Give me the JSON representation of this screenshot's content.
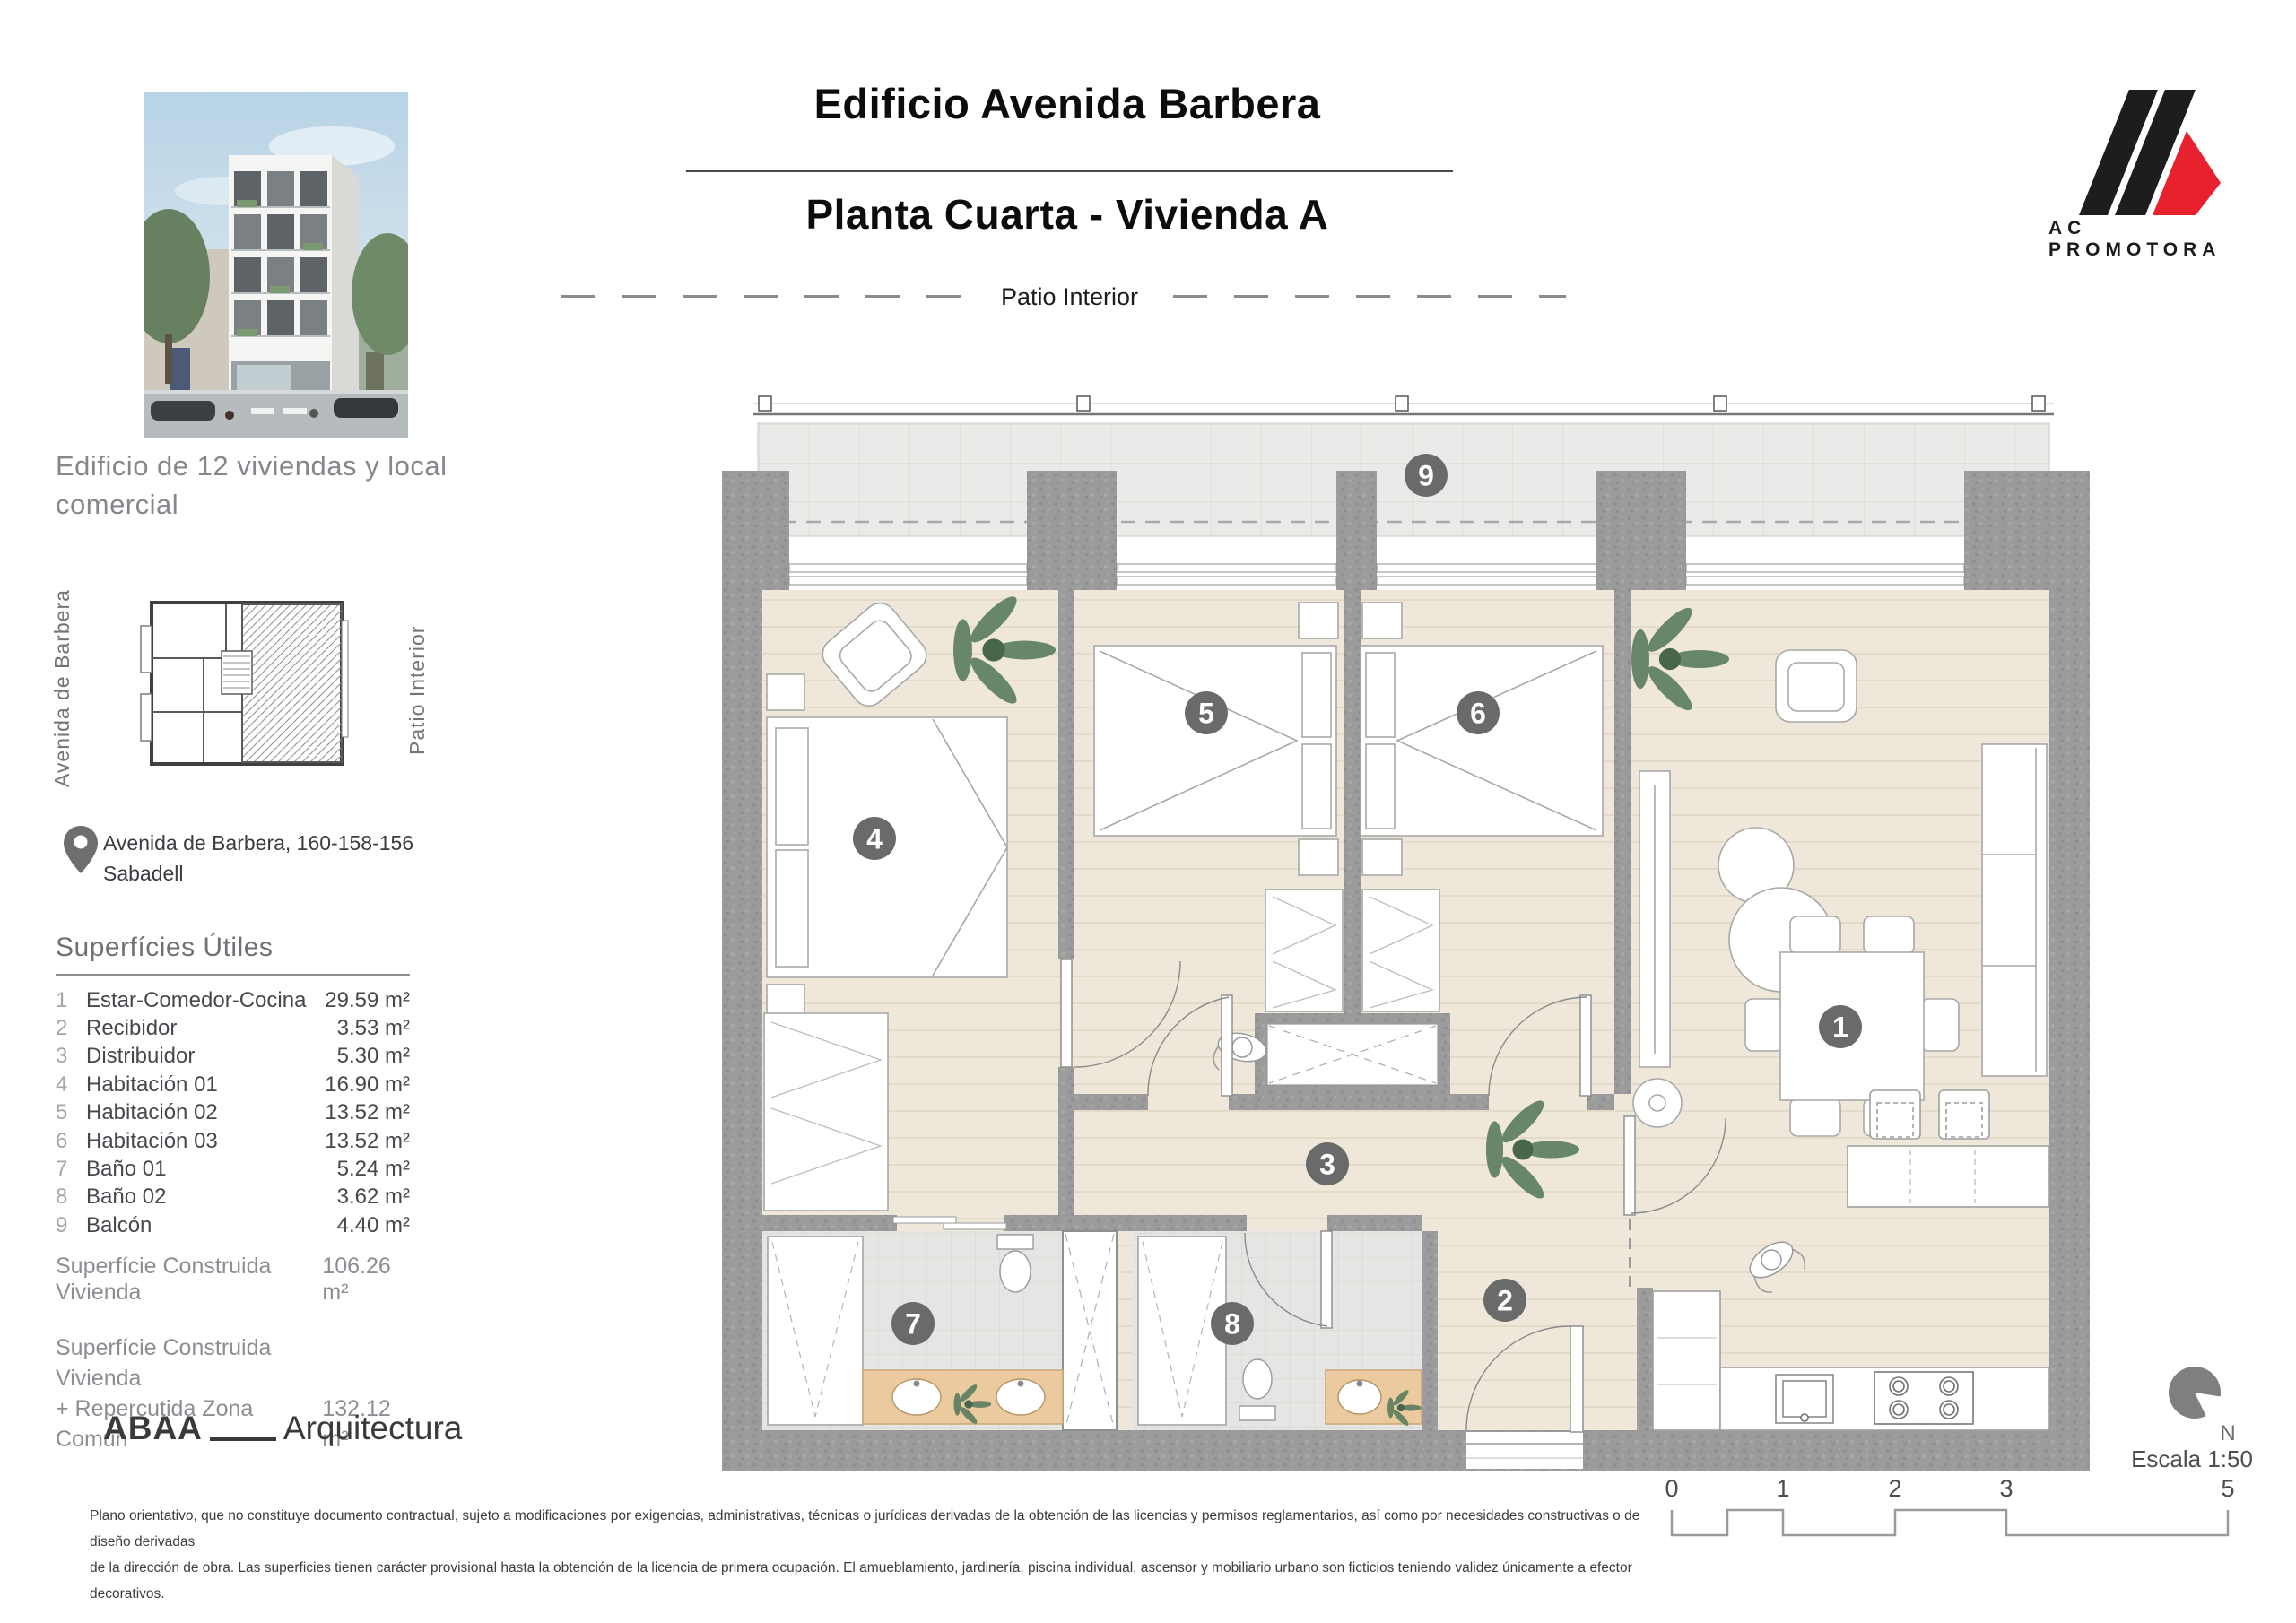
{
  "header": {
    "title": "Edificio Avenida Barbera",
    "subtitle": "Planta Cuarta - Vivienda A",
    "patio_label": "Patio Interior"
  },
  "brand": {
    "name": "AC PROMOTORA",
    "black": "#1d1d1b",
    "red": "#e8212e"
  },
  "sidebar": {
    "tagline": "Edificio de 12 viviendas y local comercial",
    "keyplan": {
      "left_label": "Avenida de Barbera",
      "right_label": "Patio Interior"
    },
    "address_line1": "Avenida de Barbera, 160-158-156",
    "address_line2": "Sabadell",
    "surfaces": {
      "title": "Superfícies Útiles",
      "rows": [
        {
          "num": "1",
          "label": "Estar-Comedor-Cocina",
          "value": "29.59 m²"
        },
        {
          "num": "2",
          "label": "Recibidor",
          "value": "3.53 m²"
        },
        {
          "num": "3",
          "label": "Distribuidor",
          "value": "5.30 m²"
        },
        {
          "num": "4",
          "label": "Habitación 01",
          "value": "16.90 m²"
        },
        {
          "num": "5",
          "label": "Habitación 02",
          "value": "13.52 m²"
        },
        {
          "num": "6",
          "label": "Habitación 03",
          "value": "13.52 m²"
        },
        {
          "num": "7",
          "label": "Baño 01",
          "value": "5.24 m²"
        },
        {
          "num": "8",
          "label": "Baño 02",
          "value": "3.62 m²"
        },
        {
          "num": "9",
          "label": "Balcón",
          "value": "4.40 m²"
        }
      ],
      "total1_label": "Superfície Construida Vivienda",
      "total1_value": "106.26 m²",
      "total2_label_line1": "Superfície Construida Vivienda",
      "total2_label_line2": "+ Repercutida Zona Común",
      "total2_value": "132.12 m²"
    },
    "architect_bold": "ABAA",
    "architect_rest": "Arquitectura"
  },
  "plan": {
    "badges": [
      {
        "number": "1"
      },
      {
        "number": "2"
      },
      {
        "number": "3"
      },
      {
        "number": "4"
      },
      {
        "number": "5"
      },
      {
        "number": "6"
      },
      {
        "number": "7"
      },
      {
        "number": "8"
      },
      {
        "number": "9"
      }
    ]
  },
  "legend": {
    "north_label": "N",
    "scale_label": "Escala 1:50",
    "scalebar_labels": [
      "0",
      "1",
      "2",
      "3",
      "5"
    ]
  },
  "disclaimer": {
    "line1": "Plano orientativo, que no constituye documento contractual, sujeto a modificaciones por exigencias, administrativas, técnicas o jurídicas derivadas de la obtención de las licencias y permisos reglamentarios, así como por necesidades constructivas o de diseño derivadas",
    "line2": "de la dirección de obra. Las superficies tienen carácter provisional hasta la obtención de la licencia de primera ocupación. El amueblamiento, jardinería, piscina individual, ascensor y mobiliario urbano son ficticios teniendo validez únicamente a efector decorativos."
  }
}
